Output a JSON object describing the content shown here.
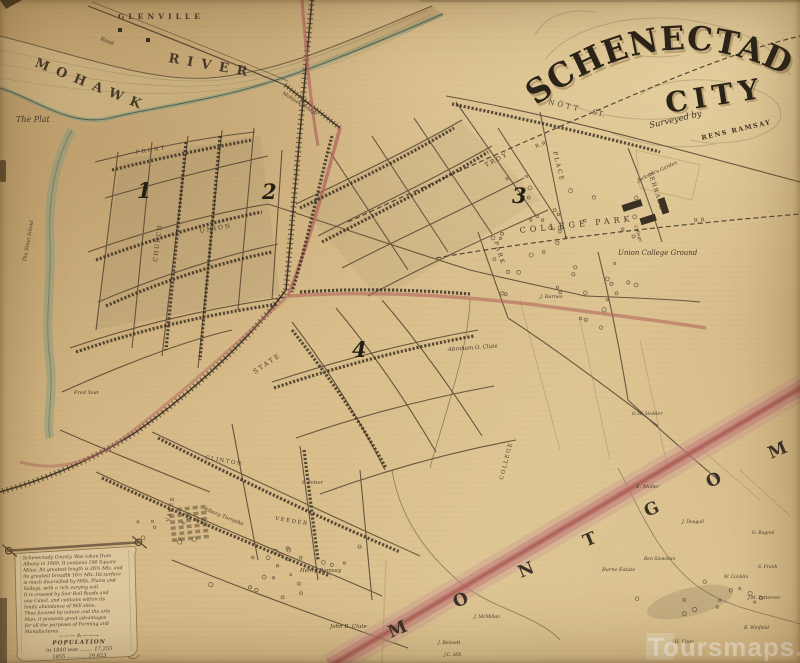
{
  "title": {
    "main": "SCHENECTADY",
    "sub": "CITY",
    "surveyed_script": "Surveyed by",
    "surveyed_name": "RENS RAMSAY"
  },
  "watermark": "Toursmaps.com",
  "colors": {
    "paper": "#d3b585",
    "ink": "#3f3629",
    "river_teal": "#6f9b85",
    "road_red": "#b2655e",
    "boundary_band": "#c4827f"
  },
  "districts": [
    {
      "n": "1",
      "x": 137,
      "y": 198
    },
    {
      "n": "2",
      "x": 262,
      "y": 199
    },
    {
      "n": "3",
      "x": 512,
      "y": 203
    },
    {
      "n": "4",
      "x": 352,
      "y": 357
    }
  ],
  "county_letters": [
    {
      "t": "M",
      "x": 391,
      "y": 638
    },
    {
      "t": "O",
      "x": 456,
      "y": 608
    },
    {
      "t": "N",
      "x": 521,
      "y": 578
    },
    {
      "t": "T",
      "x": 586,
      "y": 547
    },
    {
      "t": "G",
      "x": 647,
      "y": 517
    },
    {
      "t": "O",
      "x": 709,
      "y": 488
    },
    {
      "t": "M",
      "x": 771,
      "y": 459
    }
  ],
  "map_labels": [
    {
      "t": "GLENVILLE",
      "x": 118,
      "y": 19,
      "s": 7.5,
      "ls": 4,
      "w": 1
    },
    {
      "t": "MOHAWK",
      "x": 34,
      "y": 66,
      "s": 13,
      "r": 22,
      "ls": 8,
      "w": 1
    },
    {
      "t": "RIVER",
      "x": 168,
      "y": 62,
      "s": 13,
      "r": 10,
      "ls": 8,
      "w": 1
    },
    {
      "t": "The Plat",
      "x": 16,
      "y": 122,
      "s": 8,
      "i": 1
    },
    {
      "t": "Road",
      "x": 100,
      "y": 40,
      "s": 5.5,
      "i": 1,
      "r": 22
    },
    {
      "t": "Mohawk Bridge",
      "x": 282,
      "y": 94,
      "s": 5,
      "i": 1,
      "r": 32
    },
    {
      "t": "The Stout Island",
      "x": 26,
      "y": 262,
      "s": 5,
      "i": 1,
      "r": -80
    },
    {
      "t": "NOTT",
      "x": 548,
      "y": 104,
      "s": 7,
      "r": 13,
      "ls": 3
    },
    {
      "t": "ST.",
      "x": 592,
      "y": 114,
      "s": 7,
      "r": 13,
      "ls": 1
    },
    {
      "t": "TROY",
      "x": 486,
      "y": 167,
      "s": 6,
      "r": -27,
      "ls": 2
    },
    {
      "t": "PLACE",
      "x": 553,
      "y": 152,
      "s": 6,
      "r": 76,
      "ls": 2
    },
    {
      "t": "TERRACE",
      "x": 648,
      "y": 172,
      "s": 6,
      "r": 72,
      "ls": 1.5
    },
    {
      "t": "PARK",
      "x": 494,
      "y": 242,
      "s": 6,
      "r": 72,
      "ls": 2
    },
    {
      "t": "STATE",
      "x": 255,
      "y": 374,
      "s": 6.5,
      "r": -34,
      "ls": 2
    },
    {
      "t": "UNION",
      "x": 200,
      "y": 233,
      "s": 6,
      "r": -10,
      "ls": 2
    },
    {
      "t": "CHURCH",
      "x": 157,
      "y": 262,
      "s": 6,
      "r": -83,
      "ls": 1.5
    },
    {
      "t": "FRONT",
      "x": 136,
      "y": 154,
      "s": 5.5,
      "r": -9,
      "ls": 2
    },
    {
      "t": "CLINTON",
      "x": 205,
      "y": 459,
      "s": 5.5,
      "r": 10,
      "ls": 1.5
    },
    {
      "t": "VEEDER",
      "x": 275,
      "y": 520,
      "s": 5.5,
      "r": 9,
      "ls": 1.5
    },
    {
      "t": "YATES",
      "x": 170,
      "y": 522,
      "s": 5.5,
      "r": -80,
      "ls": 1.5
    },
    {
      "t": "COLLEGE",
      "x": 503,
      "y": 480,
      "s": 5.5,
      "r": -76,
      "ls": 1.5
    },
    {
      "t": "R. R.",
      "x": 536,
      "y": 148,
      "s": 5,
      "r": -21
    },
    {
      "t": "R. R.",
      "x": 694,
      "y": 222,
      "s": 5,
      "r": -4
    },
    {
      "t": "COLLEGE  PARK",
      "x": 520,
      "y": 233,
      "s": 8,
      "r": -6,
      "ls": 4
    },
    {
      "t": "Union College Ground",
      "x": 618,
      "y": 255,
      "s": 7,
      "i": 1
    },
    {
      "t": "Jackson's Garden",
      "x": 638,
      "y": 182,
      "s": 5,
      "i": 1,
      "r": -25
    },
    {
      "t": "College",
      "x": 634,
      "y": 226,
      "s": 4.5,
      "i": 1,
      "r": 70
    },
    {
      "t": "Abraham O. Clute",
      "x": 448,
      "y": 351,
      "s": 5.5,
      "i": 1,
      "r": -4
    },
    {
      "t": "Henry Ramsay",
      "x": 300,
      "y": 572,
      "s": 5.5,
      "i": 1
    },
    {
      "t": "John B. Clute",
      "x": 330,
      "y": 628,
      "s": 5.5,
      "i": 1
    },
    {
      "t": "P. Potter",
      "x": 302,
      "y": 484,
      "s": 5,
      "i": 1
    },
    {
      "t": "Fred Yout",
      "x": 74,
      "y": 394,
      "s": 5,
      "i": 1
    },
    {
      "t": "E. Moller",
      "x": 636,
      "y": 488,
      "s": 5,
      "i": 1
    },
    {
      "t": "G.W. Vedder",
      "x": 632,
      "y": 415,
      "s": 5,
      "i": 1
    },
    {
      "t": "J. Barnes",
      "x": 540,
      "y": 298,
      "s": 5,
      "i": 1
    },
    {
      "t": "Burne Estate",
      "x": 602,
      "y": 571,
      "s": 5,
      "i": 1
    },
    {
      "t": "Ben Slowman",
      "x": 644,
      "y": 560,
      "s": 4.5,
      "i": 1
    },
    {
      "t": "J. Dougall",
      "x": 682,
      "y": 523,
      "s": 4.5,
      "i": 1
    },
    {
      "t": "S. Frank",
      "x": 758,
      "y": 568,
      "s": 4.5,
      "i": 1
    },
    {
      "t": "W. Conklin",
      "x": 724,
      "y": 578,
      "s": 4.5,
      "i": 1
    },
    {
      "t": "J.M. Patterson",
      "x": 748,
      "y": 599,
      "s": 4.5,
      "i": 1
    },
    {
      "t": "B. Winfield",
      "x": 744,
      "y": 629,
      "s": 4.5,
      "i": 1
    },
    {
      "t": "J. McMillan",
      "x": 474,
      "y": 618,
      "s": 4.5,
      "i": 1
    },
    {
      "t": "J. Bennett",
      "x": 438,
      "y": 644,
      "s": 4.5,
      "i": 1
    },
    {
      "t": "J.C. Hill",
      "x": 444,
      "y": 656,
      "s": 4.5,
      "i": 1
    },
    {
      "t": "J.H. Clute",
      "x": 672,
      "y": 643,
      "s": 4.5,
      "i": 1
    },
    {
      "t": "G. Bagnol",
      "x": 752,
      "y": 534,
      "s": 4.5,
      "i": 1
    },
    {
      "t": "Albany Turnpike",
      "x": 204,
      "y": 510,
      "s": 5,
      "i": 1,
      "r": 22
    }
  ],
  "legend": {
    "lines": [
      "Schenectady County. Was taken from",
      "Albany in 1809. It contains 190 Square",
      "Miles. Its greatest length is 26¾ Mls. and",
      "its greatest breadth 16½ Mls. Its surface",
      "is much diversified by Hills, Plains and",
      "Valleys, with a rich varying soil.",
      "It is crossed by four Rail Roads and",
      "one Canal, and contains within its",
      "limits abundance of Mill sites.",
      "Thus favored by nature and the arts",
      "Man, it presents great advantages",
      "for all the purposes of Farming and",
      "Manufactures."
    ],
    "divider": "—·—·— ⁂ —·—·—",
    "pop_title": "POPULATION",
    "pop_rows": [
      "in 1840 was ........ 17,255",
      "1855  ............  29,623"
    ]
  }
}
